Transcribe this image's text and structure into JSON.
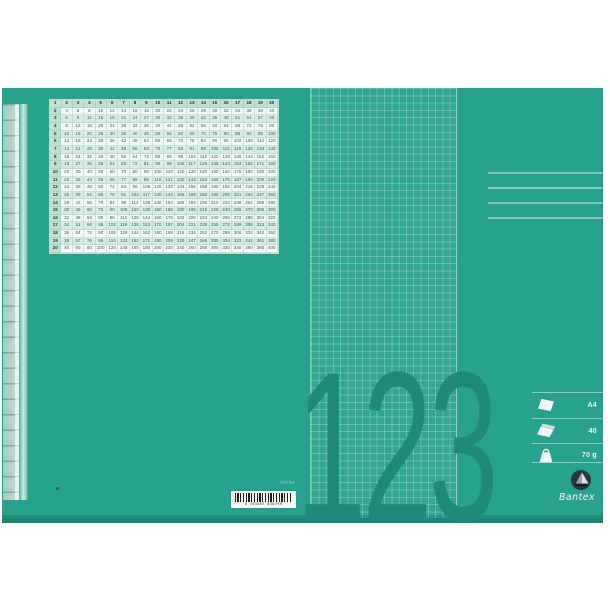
{
  "product": {
    "brand": "Bantex",
    "big_digits": "123",
    "colors": {
      "cover_green": "#28a28e",
      "digits_teal": "#1e8b79",
      "spine_pale": "#bfd9d0",
      "table_bg": "#f3faf6",
      "table_alt_bg": "#d9ece4",
      "table_header_bg": "#c3ded2",
      "barcode_label_bg": "#f7f7f3"
    },
    "specs": {
      "rows": [
        {
          "icon": "single-sheet-icon",
          "label": "A4"
        },
        {
          "icon": "sheet-stack-icon",
          "label": "40"
        },
        {
          "icon": "paper-weight-bag-icon",
          "label": "70 g"
        }
      ]
    },
    "barcode": {
      "item_code": "30799",
      "digits": "5 703467 030799"
    },
    "multiplication_table": {
      "rows": [
        [
          1,
          2,
          3,
          4,
          5,
          6,
          7,
          8,
          9,
          10,
          11,
          12,
          13,
          14,
          15,
          16,
          17,
          18,
          19,
          20
        ],
        [
          2,
          4,
          6,
          8,
          10,
          12,
          14,
          16,
          18,
          20,
          22,
          24,
          26,
          28,
          30,
          32,
          34,
          36,
          38,
          40
        ],
        [
          3,
          6,
          9,
          12,
          15,
          18,
          21,
          24,
          27,
          30,
          33,
          36,
          39,
          42,
          45,
          48,
          51,
          54,
          57,
          60
        ],
        [
          4,
          8,
          12,
          16,
          20,
          24,
          28,
          32,
          36,
          40,
          44,
          48,
          52,
          56,
          60,
          64,
          68,
          72,
          76,
          80
        ],
        [
          5,
          10,
          15,
          20,
          25,
          30,
          35,
          40,
          45,
          50,
          55,
          60,
          65,
          70,
          75,
          80,
          85,
          90,
          95,
          100
        ],
        [
          6,
          12,
          18,
          24,
          30,
          36,
          42,
          48,
          54,
          60,
          66,
          72,
          78,
          84,
          90,
          96,
          102,
          108,
          114,
          120
        ],
        [
          7,
          14,
          21,
          28,
          35,
          42,
          49,
          56,
          63,
          70,
          77,
          84,
          91,
          98,
          105,
          112,
          119,
          126,
          133,
          140
        ],
        [
          8,
          16,
          24,
          32,
          40,
          48,
          56,
          64,
          72,
          80,
          88,
          96,
          104,
          112,
          120,
          128,
          136,
          144,
          152,
          160
        ],
        [
          9,
          18,
          27,
          36,
          45,
          54,
          63,
          72,
          81,
          90,
          99,
          108,
          117,
          126,
          135,
          144,
          153,
          162,
          171,
          180
        ],
        [
          10,
          20,
          30,
          40,
          50,
          60,
          70,
          80,
          90,
          100,
          110,
          120,
          130,
          140,
          150,
          160,
          170,
          180,
          190,
          200
        ],
        [
          11,
          22,
          33,
          44,
          55,
          66,
          77,
          88,
          99,
          110,
          121,
          132,
          143,
          154,
          165,
          176,
          187,
          198,
          209,
          220
        ],
        [
          12,
          24,
          36,
          48,
          60,
          72,
          84,
          96,
          108,
          120,
          132,
          144,
          156,
          168,
          180,
          192,
          204,
          216,
          228,
          240
        ],
        [
          13,
          26,
          39,
          52,
          65,
          78,
          91,
          104,
          117,
          130,
          143,
          156,
          169,
          182,
          195,
          208,
          221,
          234,
          247,
          260
        ],
        [
          14,
          28,
          42,
          56,
          70,
          84,
          98,
          112,
          126,
          140,
          154,
          168,
          182,
          196,
          210,
          224,
          238,
          252,
          266,
          280
        ],
        [
          15,
          30,
          45,
          60,
          75,
          90,
          105,
          120,
          135,
          150,
          165,
          180,
          195,
          210,
          225,
          240,
          255,
          270,
          285,
          300
        ],
        [
          16,
          32,
          48,
          64,
          80,
          96,
          112,
          128,
          144,
          160,
          176,
          192,
          208,
          224,
          240,
          256,
          272,
          288,
          304,
          320
        ],
        [
          17,
          34,
          51,
          68,
          85,
          102,
          119,
          136,
          153,
          170,
          187,
          204,
          221,
          238,
          255,
          272,
          289,
          306,
          323,
          340
        ],
        [
          18,
          36,
          54,
          72,
          90,
          108,
          126,
          144,
          162,
          180,
          198,
          216,
          234,
          252,
          270,
          288,
          306,
          324,
          342,
          360
        ],
        [
          19,
          38,
          57,
          76,
          95,
          114,
          133,
          152,
          171,
          190,
          209,
          228,
          247,
          266,
          285,
          304,
          323,
          342,
          361,
          380
        ],
        [
          20,
          40,
          60,
          80,
          100,
          120,
          140,
          160,
          180,
          200,
          220,
          240,
          260,
          280,
          300,
          320,
          340,
          360,
          380,
          400
        ]
      ]
    }
  }
}
